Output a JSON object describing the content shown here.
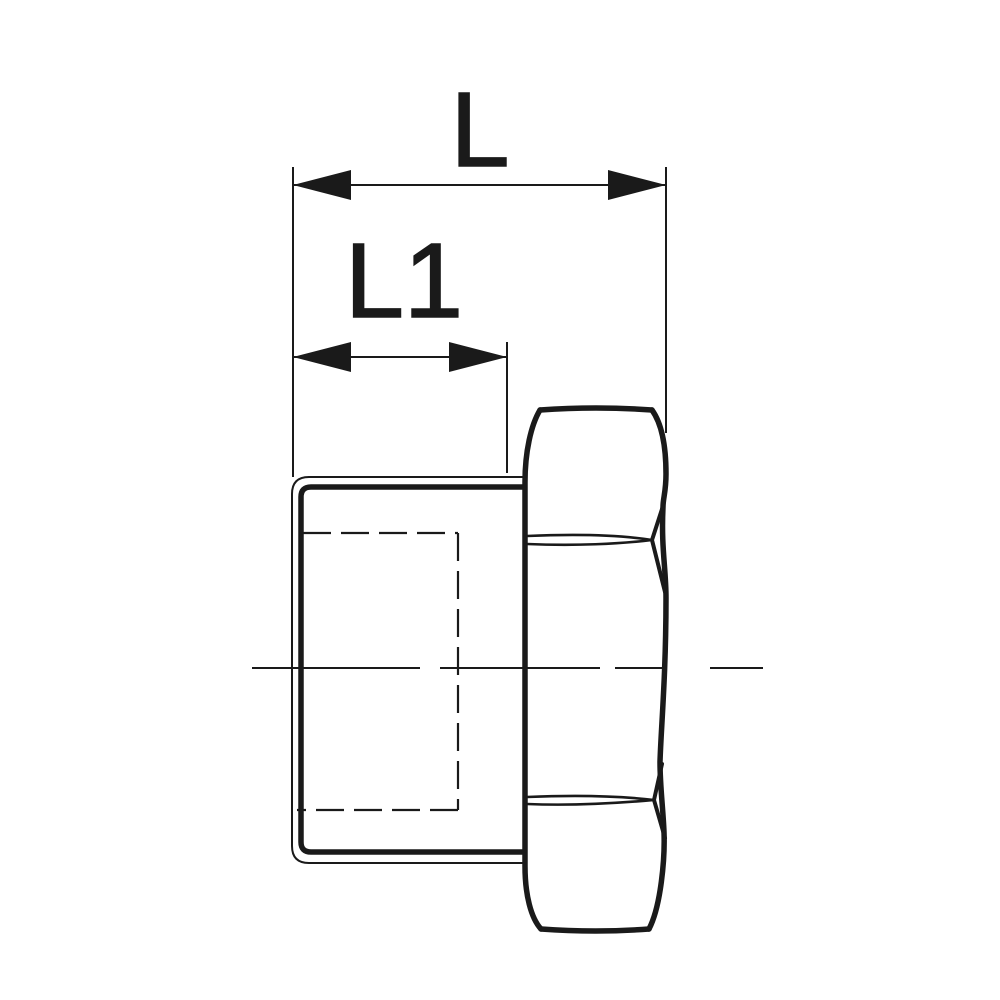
{
  "drawing": {
    "labels": {
      "dim_overall_length": "L",
      "dim_thread_length": "L1"
    },
    "colors": {
      "line": "#1a1a1a",
      "background": "#ffffff"
    }
  }
}
